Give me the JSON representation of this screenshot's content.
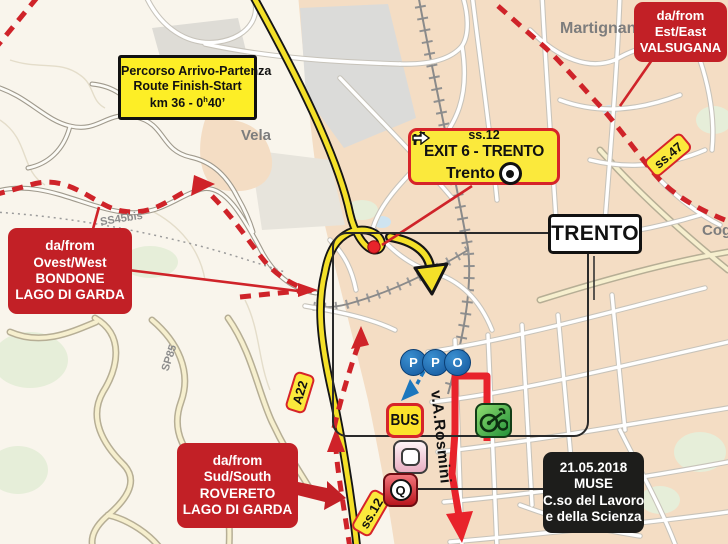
{
  "signs": {
    "percorso": {
      "line1": "Percorso Arrivo-Partenza",
      "line2": "Route Finish-Start",
      "km_pre": "km 36 - 0",
      "km_sup": "h",
      "km_post": "40’"
    },
    "exit": {
      "road": "ss.12",
      "destination": "EXIT 6 - TRENTO",
      "direction": "Trento"
    },
    "trento": {
      "label": "TRENTO"
    },
    "valsugana": {
      "line1": "da/from",
      "line2": "Est/East",
      "line3": "VALSUGANA"
    },
    "bondone": {
      "line1": "da/from",
      "line2": "Ovest/West",
      "line3": "BONDONE",
      "line4": "LAGO DI GARDA"
    },
    "rovereto": {
      "line1": "da/from",
      "line2": "Sud/South",
      "line3": "ROVERETO",
      "line4": "LAGO DI GARDA"
    },
    "muse": {
      "date": "21.05.2018",
      "venue": "MUSE",
      "address1": "C.so del Lavoro",
      "address2": "e della Scienza"
    }
  },
  "road_signs": {
    "a22": "A22",
    "ss12": "ss.12",
    "ss47": "ss.47"
  },
  "place_labels": {
    "martignano": "Martignano",
    "vela": "Vela",
    "cognola": "Cognola",
    "sp85": "SP85",
    "ss45bis": "SS45bis",
    "street_rosmini": "v.A.Rosmini"
  },
  "icons": {
    "ppo_letters": [
      "P",
      "P",
      "O"
    ],
    "bus": "BUS",
    "q_letter": "Q"
  },
  "colors": {
    "route_red": "#e8232b",
    "access_red": "#c22026",
    "sign_yellow": "#fbe93c",
    "motorway_yellow": "#f4e028",
    "map_urban": "#f4ddc4"
  }
}
